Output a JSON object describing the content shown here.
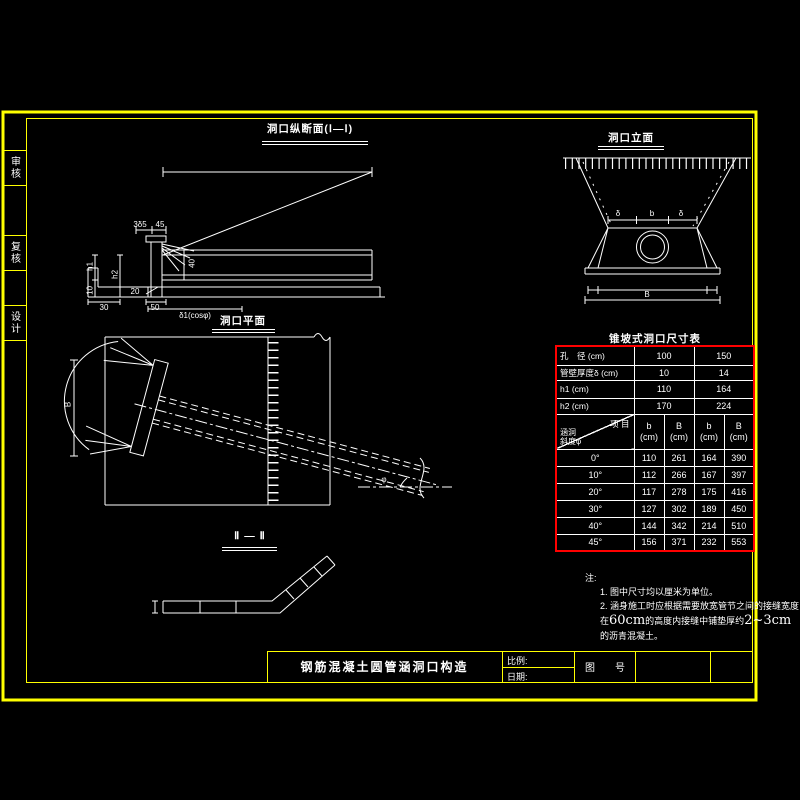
{
  "meta": {
    "background": "#000000",
    "line_color": "#ffffff",
    "frame_color": "#ffff00",
    "table_border_color": "#ff0000"
  },
  "sidebar": {
    "items": [
      {
        "label": "审核"
      },
      {
        "label": "复核"
      },
      {
        "label": "设计"
      }
    ]
  },
  "sections": {
    "longitudinal": {
      "title": "洞口纵断面(Ⅰ—Ⅰ)",
      "dims": [
        "3δ5",
        "45",
        "h1",
        "h2",
        "10",
        "30",
        "50",
        "20",
        "40",
        "δ1(cosφ)"
      ]
    },
    "elevation": {
      "title": "洞口立面",
      "dims": [
        "δ",
        "b",
        "δ",
        "B"
      ]
    },
    "plan": {
      "title": "洞口平面",
      "dims": [
        "B",
        "φ"
      ]
    },
    "section2": {
      "title": "Ⅱ — Ⅱ"
    }
  },
  "table": {
    "title": "锥坡式洞口尺寸表",
    "row_diameter": {
      "label": "孔　径 (cm)",
      "v100": "100",
      "v150": "150"
    },
    "row_thickness": {
      "label": "管壁厚度δ (cm)",
      "v100": "10",
      "v150": "14"
    },
    "row_h1": {
      "label": "h1 (cm)",
      "v100": "110",
      "v150": "164"
    },
    "row_h2": {
      "label": "h2 (cm)",
      "v100": "170",
      "v150": "224"
    },
    "diag": {
      "top": "项 目",
      "bottom1": "涵洞",
      "bottom2": "斜度φ"
    },
    "sub": {
      "letters": [
        "b",
        "B",
        "b",
        "B"
      ],
      "unit": "(cm)"
    },
    "rows": [
      {
        "angle": "0°",
        "c": [
          "110",
          "261",
          "164",
          "390"
        ]
      },
      {
        "angle": "10°",
        "c": [
          "112",
          "266",
          "167",
          "397"
        ]
      },
      {
        "angle": "20°",
        "c": [
          "117",
          "278",
          "175",
          "416"
        ]
      },
      {
        "angle": "30°",
        "c": [
          "127",
          "302",
          "189",
          "450"
        ]
      },
      {
        "angle": "40°",
        "c": [
          "144",
          "342",
          "214",
          "510"
        ]
      },
      {
        "angle": "45°",
        "c": [
          "156",
          "371",
          "232",
          "553"
        ]
      }
    ]
  },
  "notes": {
    "label": "注:",
    "item1": "1. 图中尺寸均以厘米为单位。",
    "item2": "2. 涵身施工时应根据需要放宽管节之间的接缝宽度，即",
    "item3_pre": "在",
    "item3_big1": "60cm",
    "item3_mid": "的高度内接缝中铺垫厚约",
    "item3_big2": "2~3cm",
    "item4": "的沥青混凝土。"
  },
  "titleblock": {
    "main_title": "钢筋混凝土圆管涵洞口构造",
    "scale_label": "比例:",
    "date_label": "日期:",
    "number_label": "图　　号"
  }
}
